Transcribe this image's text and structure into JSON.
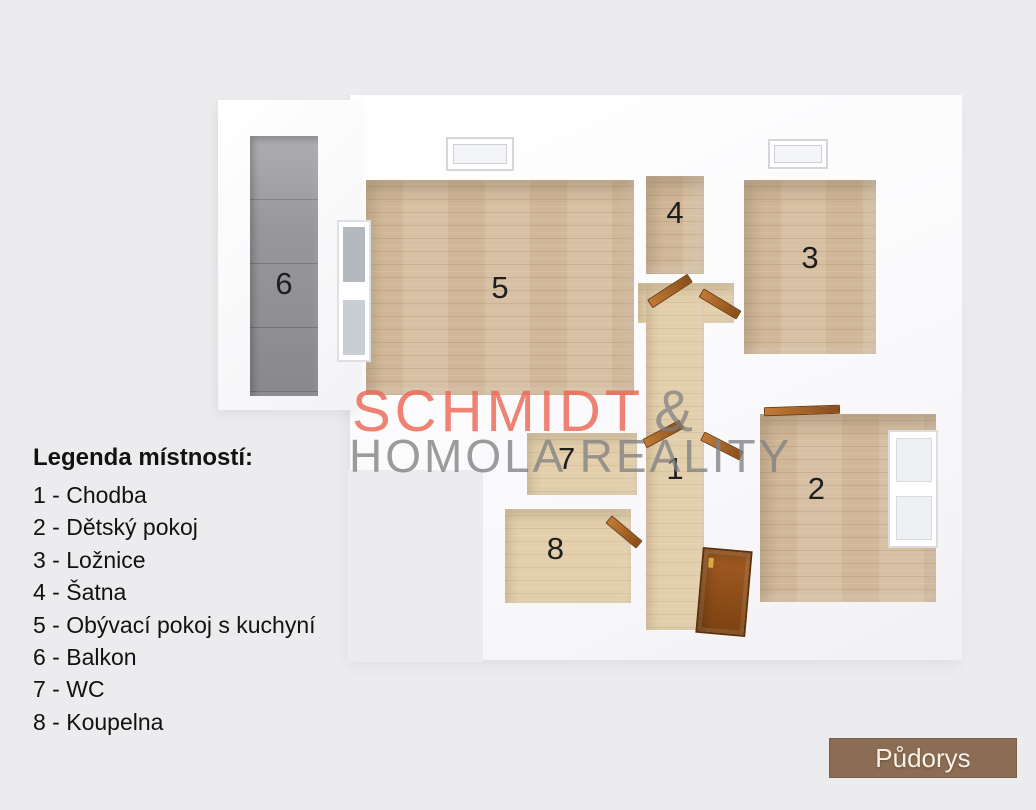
{
  "plan": {
    "badge_label": "Půdorys",
    "rooms": [
      {
        "number": "1",
        "name": "Chodba"
      },
      {
        "number": "2",
        "name": "Dětský pokoj"
      },
      {
        "number": "3",
        "name": "Ložnice"
      },
      {
        "number": "4",
        "name": "Šatna"
      },
      {
        "number": "5",
        "name": "Obývací pokoj s kuchyní"
      },
      {
        "number": "6",
        "name": "Balkon"
      },
      {
        "number": "7",
        "name": "WC"
      },
      {
        "number": "8",
        "name": "Koupelna"
      }
    ]
  },
  "watermark": {
    "primary": "SCHMIDT",
    "amp": "&",
    "secondary": "HOMOLA REALITY"
  },
  "legend": {
    "title": "Legenda místností:",
    "items": [
      "1 - Chodba",
      "2 - Dětský pokoj",
      "3 - Ložnice",
      "4 - Šatna",
      "5 - Obývací pokoj s kuchyní",
      "6 - Balkon",
      "7 - WC",
      "8 - Koupelna"
    ]
  },
  "colors": {
    "background": "#ececee",
    "wall": "#fafafc",
    "wood_floor": "#d5bc9d",
    "hall_floor": "#e3cfab",
    "balcony_floor": "#98989c",
    "door_wood": "#8a4e1a",
    "watermark_accent": "#eb6754",
    "watermark_gray": "#808083",
    "badge_background": "#8a6d52",
    "badge_text": "#f7f1e8"
  }
}
